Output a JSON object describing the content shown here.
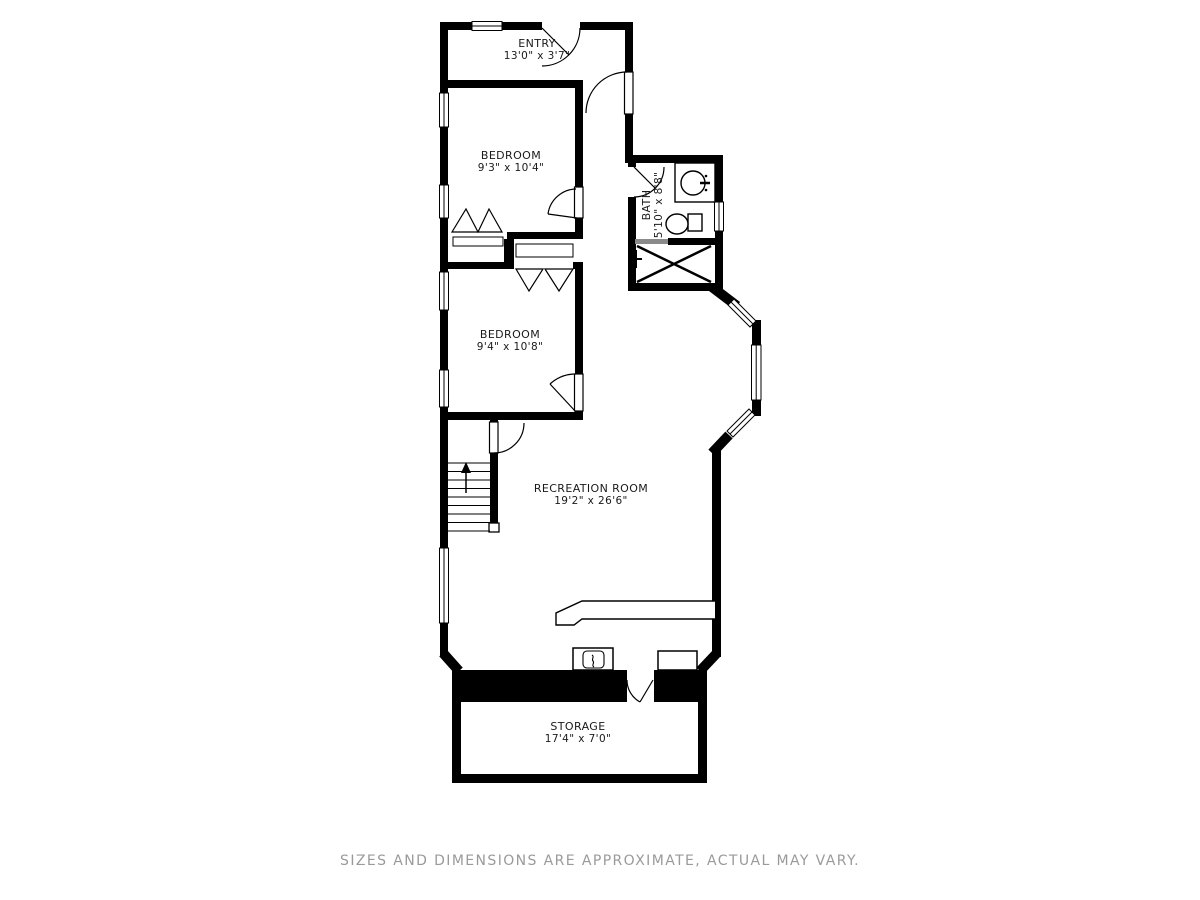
{
  "floor_plan": {
    "rooms": {
      "entry": {
        "name": "ENTRY",
        "dims": "13'0\" x 3'7\""
      },
      "bedroom_upper": {
        "name": "BEDROOM",
        "dims": "9'3\" x 10'4\""
      },
      "bath": {
        "name": "BATH",
        "dims": "5'10\" x 8'8\""
      },
      "bedroom_lower": {
        "name": "BEDROOM",
        "dims": "9'4\" x 10'8\""
      },
      "recreation": {
        "name": "RECREATION ROOM",
        "dims": "19'2\" x 26'6\""
      },
      "storage": {
        "name": "STORAGE",
        "dims": "17'4\" x 7'0\""
      }
    },
    "disclaimer": "SIZES AND DIMENSIONS ARE APPROXIMATE, ACTUAL MAY VARY.",
    "colors": {
      "wall": "#000000",
      "background": "#ffffff",
      "label_text": "#1a1a1a",
      "disclaimer_text": "#9a9a9a",
      "sliding_door": "#8a8a8a"
    }
  }
}
